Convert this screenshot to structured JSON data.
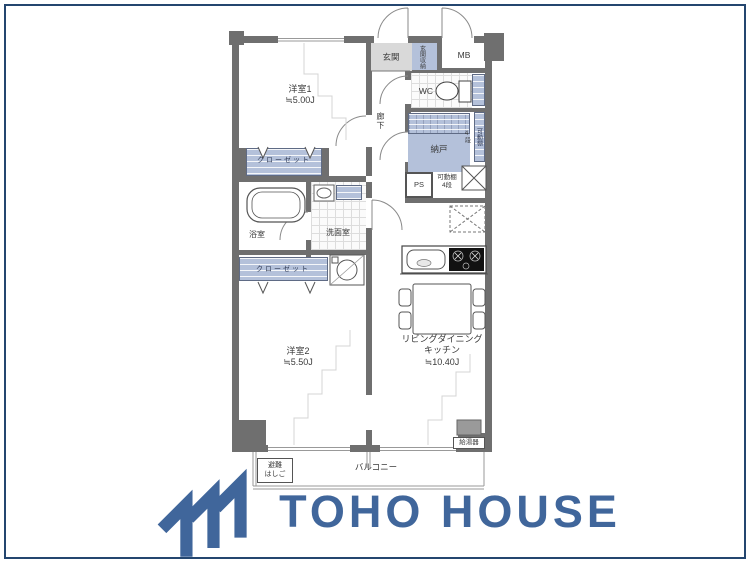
{
  "colors": {
    "wall": "#6f6f6f",
    "blue": "#b4c1da",
    "entrance": "#d9d9d9",
    "frame": "#24466f",
    "logo": "#40669b",
    "line": "#8a8a8a"
  },
  "plan": {
    "room1_name": "洋室1",
    "room1_size": "≒5.00J",
    "room2_name": "洋室2",
    "room2_size": "≒5.50J",
    "ldk_line1": "リビングダイニング",
    "ldk_line2": "キッチン",
    "ldk_size": "≒10.40J",
    "entrance": "玄関",
    "entrance_storage": "玄関収納",
    "meter_box": "MB",
    "wc": "WC",
    "hallway": "廊下",
    "storage_room": "納戸",
    "shelf_col_steps": "4段",
    "shelf_col_name": "可動棚",
    "shelf_bottom_line1": "可動棚",
    "shelf_bottom_line2": "4段",
    "pipe_space": "PS",
    "closet_upper": "クローゼット",
    "closet_lower": "クローゼット",
    "bathroom": "浴室",
    "washroom": "洗面室",
    "balcony": "バルコニー",
    "ladder_line1": "避難",
    "ladder_line2": "はしご",
    "water_heater": "給湯器"
  },
  "branding": {
    "logo_text": "TOHO HOUSE"
  }
}
